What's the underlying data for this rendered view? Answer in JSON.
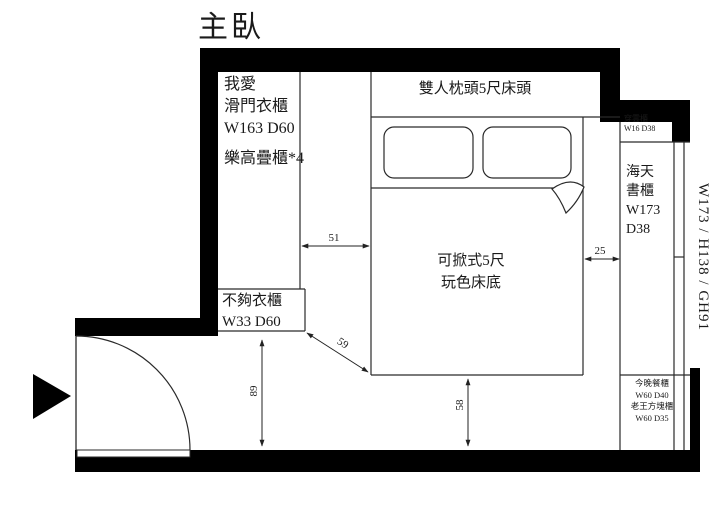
{
  "title": "主臥",
  "wardrobe": {
    "line1": "我愛",
    "line2": "滑門衣櫃",
    "line3": "W163 D60",
    "line4": "樂高疊櫃*4"
  },
  "headboard_label": "雙人枕頭5尺床頭",
  "top_cabinet": {
    "name": "穿雲櫃",
    "size": "W16 D38"
  },
  "bookcase": {
    "line1": "海天",
    "line2": "書櫃",
    "line3": "W173",
    "line4": "D38"
  },
  "window_dimension_label": "W173 / H138 / GH91",
  "bed": {
    "line1": "可掀式5尺",
    "line2": "玩色床底"
  },
  "small_wardrobe": {
    "line1": "不夠衣櫃",
    "line2": "W33 D60"
  },
  "corner_cabinets": {
    "line1": "今晚餐櫃",
    "line2": "W60 D40",
    "line3": "老王方塊櫃",
    "line4": "W60 D35"
  },
  "dimensions": {
    "wardrobe_to_bed": "51",
    "bed_to_cabinet": "25",
    "diagonal": "59",
    "entry_depth": "89",
    "bed_to_wall": "58"
  },
  "colors": {
    "wall": "#000000",
    "line": "#2a2a2a",
    "background": "#ffffff",
    "text": "#1a1a1a"
  }
}
